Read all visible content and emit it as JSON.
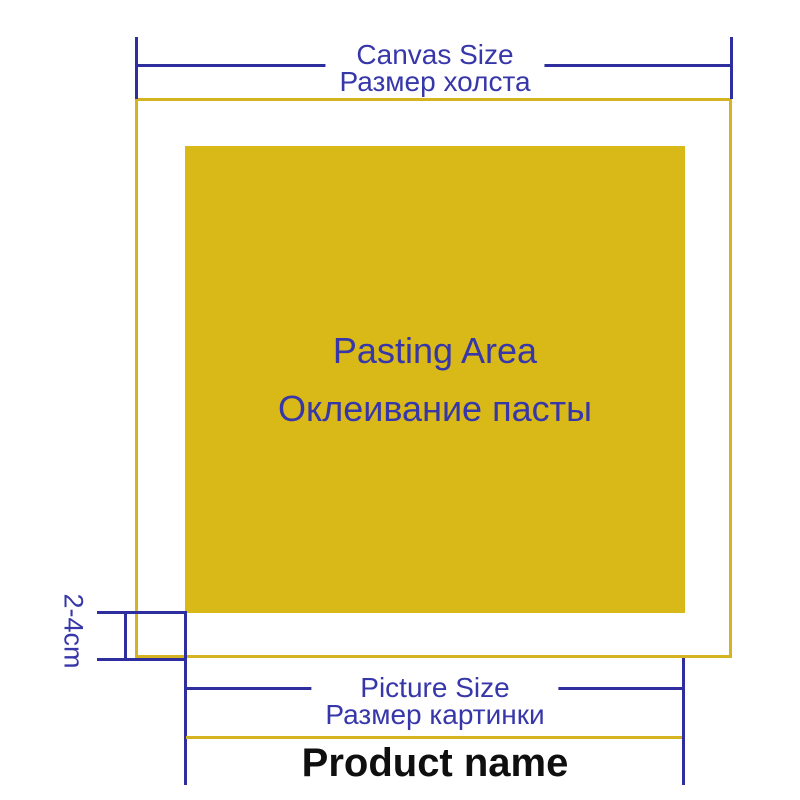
{
  "colors": {
    "dimension_blue": "#2e2e9e",
    "text_blue": "#3737a9",
    "pasting_yellow": "#d8b917",
    "border_yellow": "#d4b420",
    "product_black": "#0f0f0f",
    "background": "#ffffff"
  },
  "canvas_dimension": {
    "label_en": "Canvas Size",
    "label_ru": "Размер холста"
  },
  "pasting_area": {
    "label_en": "Pasting Area",
    "label_ru": "Оклеивание пасты"
  },
  "picture_dimension": {
    "label_en": "Picture Size",
    "label_ru": "Размер картинки"
  },
  "margin": {
    "label": "2-4cm"
  },
  "product": {
    "name": "Product name"
  }
}
